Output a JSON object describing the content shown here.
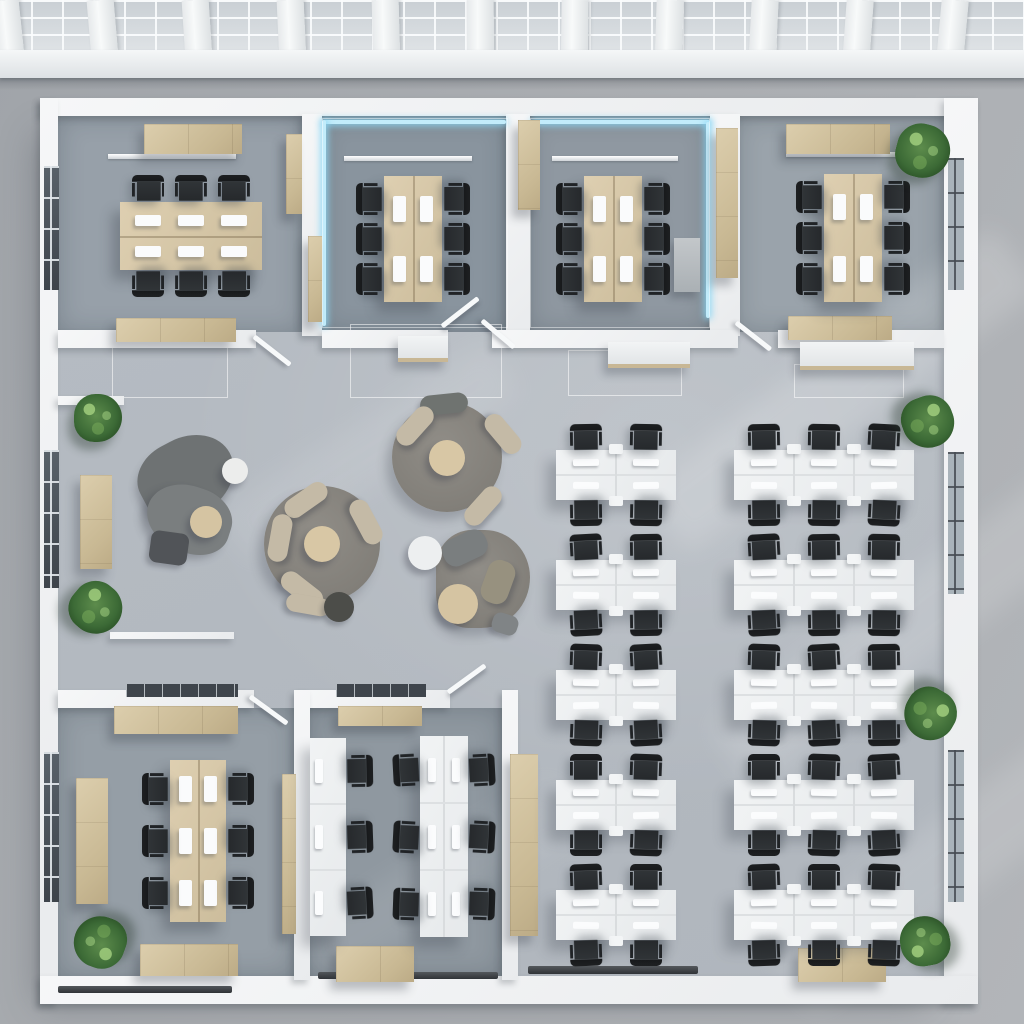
{
  "meta": {
    "title": "Top-down 3D render of an open-plan office floor with meeting rooms, lounge and workstations",
    "view": "top-down-floor-plan",
    "palette": {
      "concrete": "#a8abaf",
      "floor": "#b3b9c0",
      "room_floor": "#919aa3",
      "wall": "#f3f5f6",
      "wood": "#cfc0a0",
      "desk_white": "#eef0f2",
      "chair_dark": "#26292c",
      "led_blue": "#c2ecfb",
      "plant_green": "#3c6a36",
      "rug_gray": "#84817b",
      "seat_beige": "#c4baa6"
    }
  },
  "ceiling": {
    "h": 52,
    "fasciaY": 50,
    "fasciaH": 28,
    "beamW": 27,
    "tilt": 0.012,
    "beams": [
      10,
      104,
      198,
      292,
      386,
      480,
      574,
      668,
      762,
      856,
      950
    ]
  },
  "items": [
    {
      "t": "base",
      "x": 56,
      "y": 114,
      "w": 890,
      "h": 868
    },
    {
      "t": "fl",
      "x": 58,
      "y": 116,
      "w": 244,
      "h": 216,
      "c": "#97a0a9"
    },
    {
      "t": "fl",
      "x": 320,
      "y": 116,
      "w": 188,
      "h": 216,
      "c": "#89949e"
    },
    {
      "t": "fl",
      "x": 528,
      "y": 116,
      "w": 182,
      "h": 216,
      "c": "#8f98a1"
    },
    {
      "t": "fl",
      "x": 736,
      "y": 116,
      "w": 208,
      "h": 216,
      "c": "#9aa3ab"
    },
    {
      "t": "fl",
      "x": 58,
      "y": 708,
      "w": 236,
      "h": 268,
      "c": "#959ea6"
    },
    {
      "t": "fl",
      "x": 310,
      "y": 708,
      "w": 192,
      "h": 268,
      "c": "#8f98a0"
    },
    {
      "t": "sun",
      "x": 620,
      "y": 350,
      "w": 440,
      "h": 80,
      "r": -37,
      "o": 0.16
    },
    {
      "t": "sun",
      "x": 690,
      "y": 590,
      "w": 430,
      "h": 80,
      "r": -37,
      "o": 0.14
    },
    {
      "t": "sun",
      "x": 750,
      "y": 820,
      "w": 400,
      "h": 80,
      "r": -37,
      "o": 0.13
    },
    {
      "t": "sun",
      "x": 210,
      "y": 420,
      "w": 320,
      "h": 64,
      "r": -32,
      "o": 0.09
    },
    {
      "t": "sun",
      "x": 290,
      "y": 850,
      "w": 300,
      "h": 60,
      "r": -32,
      "o": 0.08
    },
    {
      "t": "bal",
      "x": 112,
      "y": 344,
      "w": 116,
      "h": 54
    },
    {
      "t": "bal",
      "x": 350,
      "y": 324,
      "w": 152,
      "h": 74
    },
    {
      "t": "bal",
      "x": 568,
      "y": 350,
      "w": 114,
      "h": 46
    },
    {
      "t": "bal",
      "x": 794,
      "y": 364,
      "w": 110,
      "h": 34
    },
    {
      "t": "w",
      "x": 40,
      "y": 98,
      "w": 938,
      "h": 18
    },
    {
      "t": "w",
      "x": 40,
      "y": 98,
      "w": 18,
      "h": 906
    },
    {
      "t": "w",
      "x": 944,
      "y": 98,
      "w": 34,
      "h": 906
    },
    {
      "t": "w",
      "x": 40,
      "y": 976,
      "w": 938,
      "h": 28
    },
    {
      "t": "w",
      "x": 302,
      "y": 114,
      "w": 20,
      "h": 222
    },
    {
      "t": "w",
      "x": 506,
      "y": 114,
      "w": 24,
      "h": 222
    },
    {
      "t": "w",
      "x": 710,
      "y": 114,
      "w": 30,
      "h": 222
    },
    {
      "t": "w",
      "x": 58,
      "y": 330,
      "w": 198,
      "h": 18
    },
    {
      "t": "w",
      "x": 322,
      "y": 330,
      "w": 126,
      "h": 18
    },
    {
      "t": "w",
      "x": 492,
      "y": 330,
      "w": 246,
      "h": 18
    },
    {
      "t": "w",
      "x": 778,
      "y": 330,
      "w": 166,
      "h": 18
    },
    {
      "t": "w",
      "x": 58,
      "y": 690,
      "w": 196,
      "h": 18
    },
    {
      "t": "w",
      "x": 300,
      "y": 690,
      "w": 150,
      "h": 18
    },
    {
      "t": "w",
      "x": 294,
      "y": 690,
      "w": 16,
      "h": 290
    },
    {
      "t": "w",
      "x": 502,
      "y": 690,
      "w": 16,
      "h": 290
    },
    {
      "t": "w",
      "x": 58,
      "y": 396,
      "w": 66,
      "h": 9
    },
    {
      "t": "w",
      "x": 110,
      "y": 632,
      "w": 124,
      "h": 7
    },
    {
      "t": "win",
      "cls": "windark",
      "x": 44,
      "y": 166,
      "w": 15,
      "h": 124
    },
    {
      "t": "win",
      "cls": "windark",
      "x": 44,
      "y": 450,
      "w": 15,
      "h": 138
    },
    {
      "t": "win",
      "cls": "windark",
      "x": 44,
      "y": 752,
      "w": 15,
      "h": 150
    },
    {
      "t": "win",
      "cls": "winlight",
      "x": 948,
      "y": 158,
      "w": 16,
      "h": 132
    },
    {
      "t": "win",
      "cls": "winlight",
      "x": 948,
      "y": 452,
      "w": 16,
      "h": 142
    },
    {
      "t": "win",
      "cls": "winlight",
      "x": 948,
      "y": 750,
      "w": 16,
      "h": 152
    },
    {
      "t": "tr",
      "x": 126,
      "y": 684,
      "w": 112,
      "h": 13
    },
    {
      "t": "tr",
      "x": 336,
      "y": 684,
      "w": 90,
      "h": 13
    },
    {
      "t": "tk",
      "x": 528,
      "y": 966,
      "w": 170,
      "h": 8
    },
    {
      "t": "tk",
      "x": 318,
      "y": 972,
      "w": 180,
      "h": 7
    },
    {
      "t": "tk",
      "x": 58,
      "y": 986,
      "w": 174,
      "h": 7
    },
    {
      "t": "led",
      "x": 324,
      "y": 120,
      "w": 182,
      "h": 4
    },
    {
      "t": "led",
      "x": 322,
      "y": 120,
      "w": 4,
      "h": 206
    },
    {
      "t": "led",
      "x": 532,
      "y": 120,
      "w": 178,
      "h": 4
    },
    {
      "t": "led",
      "x": 706,
      "y": 122,
      "w": 4,
      "h": 196
    },
    {
      "t": "gl",
      "x": 322,
      "y": 118,
      "w": 186,
      "h": 210
    },
    {
      "t": "gl",
      "x": 530,
      "y": 118,
      "w": 180,
      "h": 210
    },
    {
      "t": "li",
      "x": 108,
      "y": 154,
      "w": 128,
      "h": 5
    },
    {
      "t": "li",
      "x": 344,
      "y": 156,
      "w": 128,
      "h": 5
    },
    {
      "t": "li",
      "x": 552,
      "y": 156,
      "w": 126,
      "h": 5
    },
    {
      "t": "li",
      "x": 786,
      "y": 152,
      "w": 126,
      "h": 5
    },
    {
      "t": "rug",
      "x": 392,
      "y": 402,
      "w": 110,
      "h": 110
    },
    {
      "t": "rug",
      "x": 264,
      "y": 486,
      "w": 116,
      "h": 116
    },
    {
      "t": "rug",
      "x": 436,
      "y": 530,
      "w": 94,
      "h": 98,
      "br": "44% 56% 60% 40%"
    },
    {
      "t": "blob",
      "x": 138,
      "y": 438,
      "w": 98,
      "h": 78,
      "r": -28,
      "c": "#6e7273",
      "br": "46% 54% 58% 42%"
    },
    {
      "t": "blob",
      "x": 146,
      "y": 486,
      "w": 86,
      "h": 66,
      "r": 18,
      "c": "#7a7e7f",
      "br": "52% 48% 44% 56%"
    },
    {
      "t": "ott",
      "x": 150,
      "y": 532,
      "w": 38,
      "h": 32,
      "r": 8,
      "c": "#515458"
    },
    {
      "t": "circ",
      "x": 222,
      "y": 458,
      "d": 26,
      "c": "#ecedec"
    },
    {
      "t": "circ",
      "x": 190,
      "y": 506,
      "d": 32,
      "c": "#d5c4a2"
    },
    {
      "t": "circ",
      "x": 304,
      "y": 526,
      "d": 36,
      "c": "#d8c7a5"
    },
    {
      "t": "seat",
      "x": 282,
      "y": 490,
      "w": 48,
      "h": 20,
      "r": -35
    },
    {
      "t": "seat",
      "x": 256,
      "y": 528,
      "w": 48,
      "h": 20,
      "r": -80
    },
    {
      "t": "seat",
      "x": 278,
      "y": 580,
      "w": 48,
      "h": 20,
      "r": 38
    },
    {
      "t": "seat",
      "x": 342,
      "y": 512,
      "w": 48,
      "h": 20,
      "r": 62
    },
    {
      "t": "seat",
      "x": 286,
      "y": 596,
      "w": 44,
      "h": 18,
      "r": 10
    },
    {
      "t": "ott",
      "x": 324,
      "y": 592,
      "d": 30,
      "c": "#4c4d49"
    },
    {
      "t": "circ",
      "x": 429,
      "y": 440,
      "d": 36,
      "c": "#d8c7a5"
    },
    {
      "t": "seat",
      "x": 420,
      "y": 394,
      "w": 48,
      "h": 20,
      "r": -6,
      "c": "#6f7370"
    },
    {
      "t": "seat",
      "x": 392,
      "y": 416,
      "w": 46,
      "h": 20,
      "r": -48
    },
    {
      "t": "seat",
      "x": 480,
      "y": 424,
      "w": 46,
      "h": 20,
      "r": 50
    },
    {
      "t": "seat",
      "x": 460,
      "y": 496,
      "w": 46,
      "h": 20,
      "r": -48
    },
    {
      "t": "seat",
      "x": 442,
      "y": 534,
      "w": 46,
      "h": 28,
      "r": -25,
      "c": "#7a7e7f"
    },
    {
      "t": "seat",
      "x": 476,
      "y": 568,
      "w": 44,
      "h": 28,
      "r": -70,
      "c": "#97917f"
    },
    {
      "t": "ott",
      "x": 492,
      "y": 614,
      "w": 26,
      "h": 20,
      "r": 18,
      "c": "#808486"
    },
    {
      "t": "circ",
      "x": 408,
      "y": 536,
      "d": 34,
      "c": "#edeff0"
    },
    {
      "t": "circ",
      "x": 438,
      "y": 584,
      "d": 40,
      "c": "#d5c4a2"
    },
    {
      "t": "wood",
      "x": 144,
      "y": 124,
      "w": 98,
      "h": 30,
      "n": "credenza"
    },
    {
      "t": "wood",
      "x": 116,
      "y": 318,
      "w": 120,
      "h": 24,
      "n": "credenza"
    },
    {
      "t": "wood",
      "x": 786,
      "y": 124,
      "w": 104,
      "h": 30,
      "n": "credenza"
    },
    {
      "t": "wood",
      "x": 788,
      "y": 316,
      "w": 104,
      "h": 24,
      "n": "credenza"
    },
    {
      "t": "wood",
      "x": 114,
      "y": 706,
      "w": 124,
      "h": 28,
      "n": "credenza"
    },
    {
      "t": "wood",
      "x": 140,
      "y": 944,
      "w": 98,
      "h": 32,
      "n": "credenza"
    },
    {
      "t": "wood",
      "x": 798,
      "y": 948,
      "w": 88,
      "h": 34,
      "n": "credenza"
    },
    {
      "t": "wood",
      "x": 338,
      "y": 706,
      "w": 84,
      "h": 20,
      "n": "credenza"
    },
    {
      "t": "wood",
      "x": 336,
      "y": 946,
      "w": 78,
      "h": 36,
      "n": "credenza"
    },
    {
      "t": "wood",
      "x": 286,
      "y": 134,
      "w": 16,
      "h": 80,
      "n": "storage-cabinet"
    },
    {
      "t": "wood",
      "x": 308,
      "y": 236,
      "w": 14,
      "h": 86,
      "n": "storage-cabinet"
    },
    {
      "t": "wood",
      "x": 518,
      "y": 120,
      "w": 22,
      "h": 90,
      "n": "storage-cabinet"
    },
    {
      "t": "wood",
      "x": 716,
      "y": 128,
      "w": 22,
      "h": 150,
      "n": "storage-cabinet"
    },
    {
      "t": "wood",
      "x": 76,
      "y": 778,
      "w": 32,
      "h": 126,
      "n": "storage-cabinet"
    },
    {
      "t": "wood",
      "x": 282,
      "y": 774,
      "w": 14,
      "h": 160,
      "n": "storage-cabinet"
    },
    {
      "t": "wood",
      "x": 510,
      "y": 754,
      "w": 28,
      "h": 182,
      "n": "storage-cabinet"
    },
    {
      "t": "wood",
      "x": 80,
      "y": 475,
      "w": 32,
      "h": 94,
      "n": "sideboard"
    },
    {
      "t": "sb",
      "x": 398,
      "y": 336,
      "w": 50,
      "h": 26
    },
    {
      "t": "sb",
      "x": 608,
      "y": 342,
      "w": 82,
      "h": 26
    },
    {
      "t": "sb",
      "x": 800,
      "y": 342,
      "w": 114,
      "h": 28
    },
    {
      "t": "con",
      "x": 674,
      "y": 238,
      "w": 26,
      "h": 54
    },
    {
      "t": "table",
      "x": 120,
      "y": 202,
      "w": 142,
      "h": 68,
      "orient": "h",
      "pr": 2
    },
    {
      "t": "table",
      "x": 384,
      "y": 176,
      "w": 58,
      "h": 126,
      "orient": "v",
      "pr": 2
    },
    {
      "t": "table",
      "x": 584,
      "y": 176,
      "w": 58,
      "h": 126,
      "orient": "v",
      "pr": 2
    },
    {
      "t": "table",
      "x": 824,
      "y": 174,
      "w": 58,
      "h": 128,
      "orient": "v",
      "pr": 2
    },
    {
      "t": "table",
      "x": 170,
      "y": 760,
      "w": 56,
      "h": 162,
      "orient": "v",
      "pr": 3
    },
    {
      "t": "bank",
      "x": 556,
      "y": 450,
      "u": 2
    },
    {
      "t": "bank",
      "x": 734,
      "y": 450,
      "u": 3
    },
    {
      "t": "bank",
      "x": 556,
      "y": 560,
      "u": 2
    },
    {
      "t": "bank",
      "x": 734,
      "y": 560,
      "u": 3
    },
    {
      "t": "bank",
      "x": 556,
      "y": 670,
      "u": 2
    },
    {
      "t": "bank",
      "x": 734,
      "y": 670,
      "u": 3
    },
    {
      "t": "bank",
      "x": 556,
      "y": 780,
      "u": 2
    },
    {
      "t": "bank",
      "x": 734,
      "y": 780,
      "u": 3
    },
    {
      "t": "bank",
      "x": 556,
      "y": 890,
      "u": 2
    },
    {
      "t": "bank",
      "x": 734,
      "y": 890,
      "u": 3
    },
    {
      "t": "vbank",
      "x": 310,
      "y": 738,
      "cols": 1,
      "rows": 3,
      "cw": 36,
      "ch": 66,
      "side": "right"
    },
    {
      "t": "vbank",
      "x": 420,
      "y": 736,
      "cols": 2,
      "rows": 3,
      "cw": 24,
      "ch": 67,
      "side": "both"
    },
    {
      "t": "door",
      "x": 254,
      "y": 334,
      "len": 46,
      "r": 38
    },
    {
      "t": "door",
      "x": 442,
      "y": 324,
      "len": 46,
      "r": -38
    },
    {
      "t": "door",
      "x": 482,
      "y": 318,
      "len": 42,
      "r": 40
    },
    {
      "t": "door",
      "x": 736,
      "y": 320,
      "len": 44,
      "r": 38
    },
    {
      "t": "door",
      "x": 250,
      "y": 694,
      "len": 46,
      "r": 36
    },
    {
      "t": "door",
      "x": 448,
      "y": 690,
      "len": 46,
      "r": -36
    },
    {
      "t": "plant",
      "x": 74,
      "y": 394,
      "d": 48,
      "r": 0
    },
    {
      "t": "plant",
      "x": 70,
      "y": 582,
      "d": 52,
      "r": 40
    },
    {
      "t": "plant",
      "x": 896,
      "y": 124,
      "d": 54,
      "r": 15
    },
    {
      "t": "plant",
      "x": 902,
      "y": 396,
      "d": 52,
      "r": 70
    },
    {
      "t": "plant",
      "x": 904,
      "y": 688,
      "d": 52,
      "r": 120
    },
    {
      "t": "plant",
      "x": 74,
      "y": 916,
      "d": 52,
      "r": 200
    },
    {
      "t": "plant",
      "x": 900,
      "y": 916,
      "d": 50,
      "r": 260
    }
  ]
}
